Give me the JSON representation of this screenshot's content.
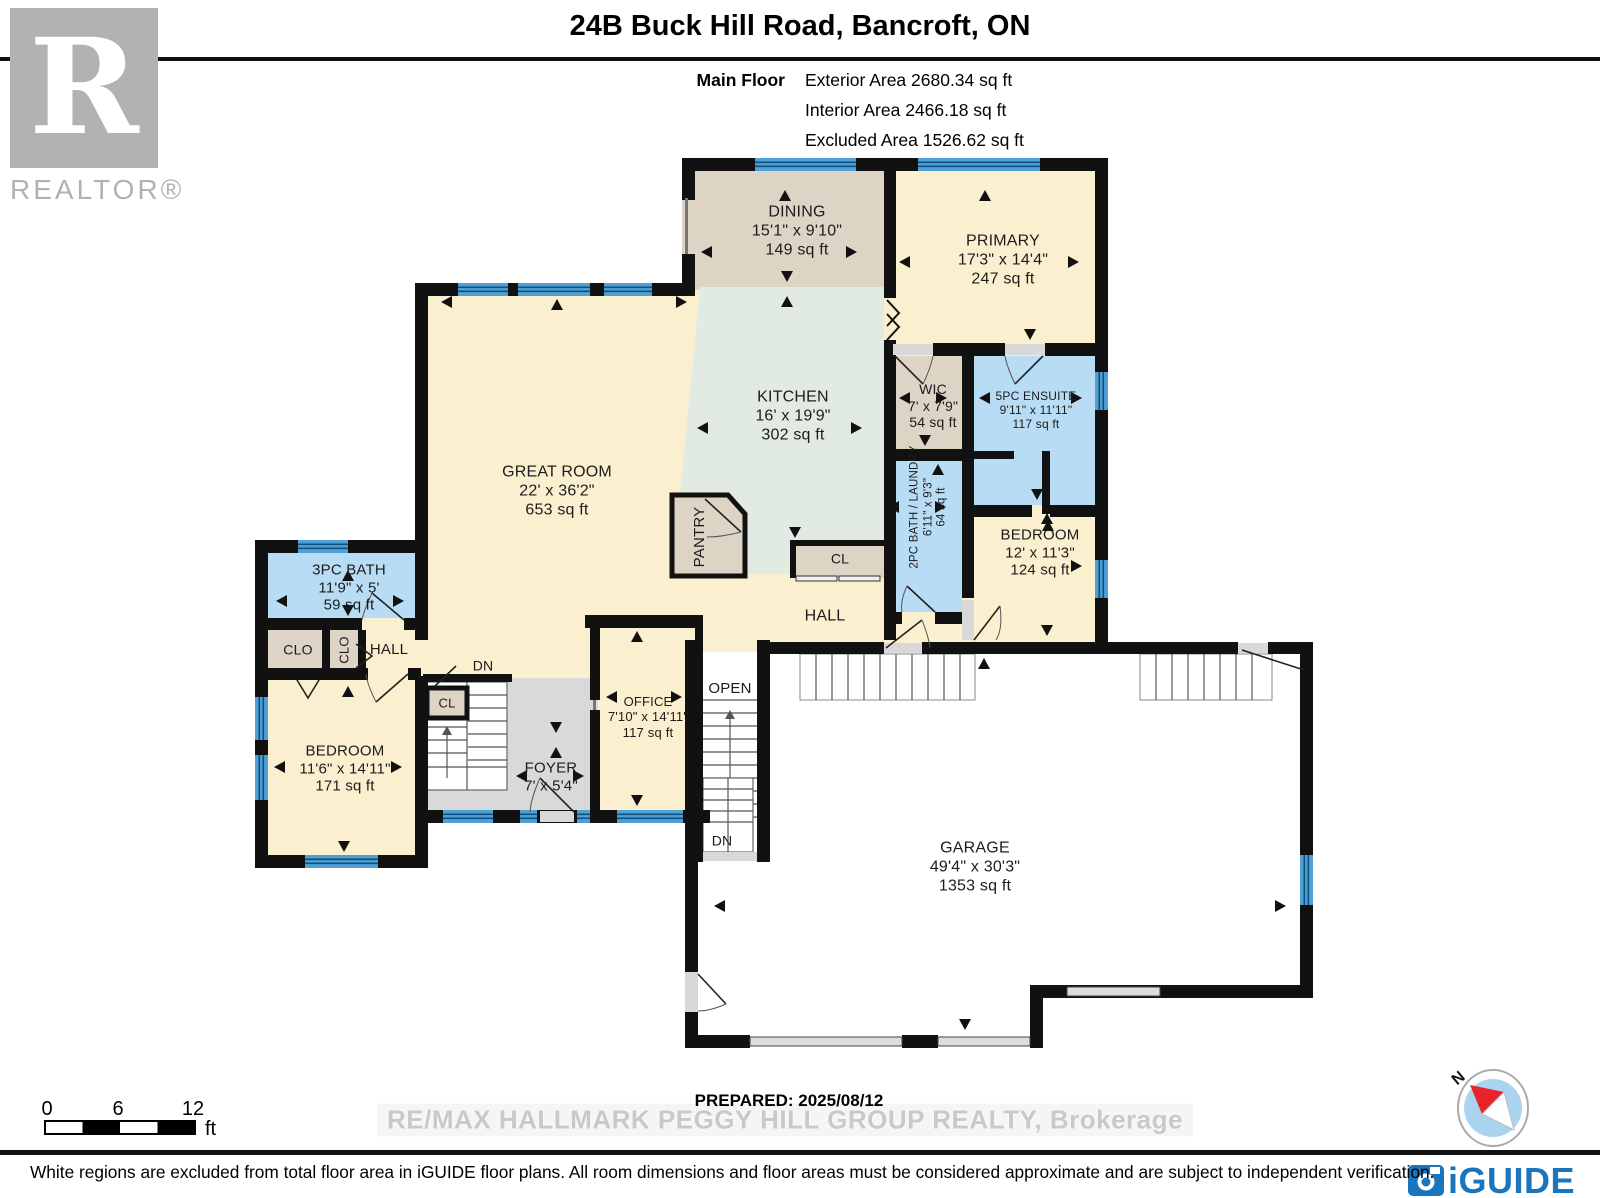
{
  "header": {
    "title": "24B Buck Hill Road, Bancroft, ON",
    "floor_label": "Main Floor",
    "stat_exterior": "Exterior Area 2680.34 sq ft",
    "stat_interior": "Interior Area 2466.18 sq ft",
    "stat_excluded": "Excluded Area 1526.62 sq ft"
  },
  "branding": {
    "realtor_logo_letter": "R",
    "realtor_logo_text": "REALTOR®",
    "iguide_logo_text": "iGUIDE",
    "watermark": "RE/MAX HALLMARK PEGGY HILL GROUP REALTY, Brokerage"
  },
  "rooms": {
    "dining": {
      "name": "DINING",
      "dims": "15'1\" x 9'10\"",
      "area": "149 sq ft"
    },
    "primary": {
      "name": "PRIMARY",
      "dims": "17'3\" x 14'4\"",
      "area": "247 sq ft"
    },
    "kitchen": {
      "name": "KITCHEN",
      "dims": "16' x 19'9\"",
      "area": "302 sq ft"
    },
    "great_room": {
      "name": "GREAT ROOM",
      "dims": "22' x 36'2\"",
      "area": "653 sq ft"
    },
    "wic": {
      "name": "WIC",
      "dims": "7' x 7'9\"",
      "area": "54 sq ft"
    },
    "ensuite": {
      "name": "5PC ENSUITE",
      "dims": "9'11\" x 11'11\"",
      "area": "117 sq ft"
    },
    "bath_laundry": {
      "name": "2PC BATH / LAUNDRY",
      "dims": "6'11\" x 9'3\"",
      "area": "64 sq ft"
    },
    "bedroom_right": {
      "name": "BEDROOM",
      "dims": "12' x 11'3\"",
      "area": "124 sq ft"
    },
    "bath_3pc": {
      "name": "3PC BATH",
      "dims": "11'9\" x 5'",
      "area": "59 sq ft"
    },
    "bedroom_left": {
      "name": "BEDROOM",
      "dims": "11'6\" x 14'11\"",
      "area": "171 sq ft"
    },
    "office": {
      "name": "OFFICE",
      "dims": "7'10\" x 14'11\"",
      "area": "117 sq ft"
    },
    "foyer": {
      "name": "FOYER",
      "dims": "7' x 5'4\""
    },
    "garage": {
      "name": "GARAGE",
      "dims": "49'4\" x 30'3\"",
      "area": "1353 sq ft"
    }
  },
  "labels": {
    "pantry": "PANTRY",
    "hall_upper": "HALL",
    "hall_lower": "HALL",
    "clo_a": "CLO",
    "clo_b": "CLO",
    "cl_kitchen": "CL",
    "cl_foyer": "CL",
    "open": "OPEN",
    "dn_foyer": "DN",
    "dn_garage": "DN"
  },
  "footer": {
    "prepared": "PREPARED: 2025/08/12",
    "disclaimer": "White regions are excluded from total floor area in iGUIDE floor plans. All room dimensions and floor areas must be considered approximate and are subject to independent verification.",
    "scale": {
      "ticks": [
        "0",
        "6",
        "12"
      ],
      "unit": "ft"
    },
    "compass_north": "N"
  },
  "colors": {
    "cream": "#faf0cf",
    "tan": "#ddd4c6",
    "mint": "#e2ebe3",
    "blue_room": "#b8dcf4",
    "window_blue": "#4fa0d4",
    "floor_gray": "#d9d9d9",
    "wall_black": "#111111",
    "iguide_blue": "#1b75bc"
  }
}
